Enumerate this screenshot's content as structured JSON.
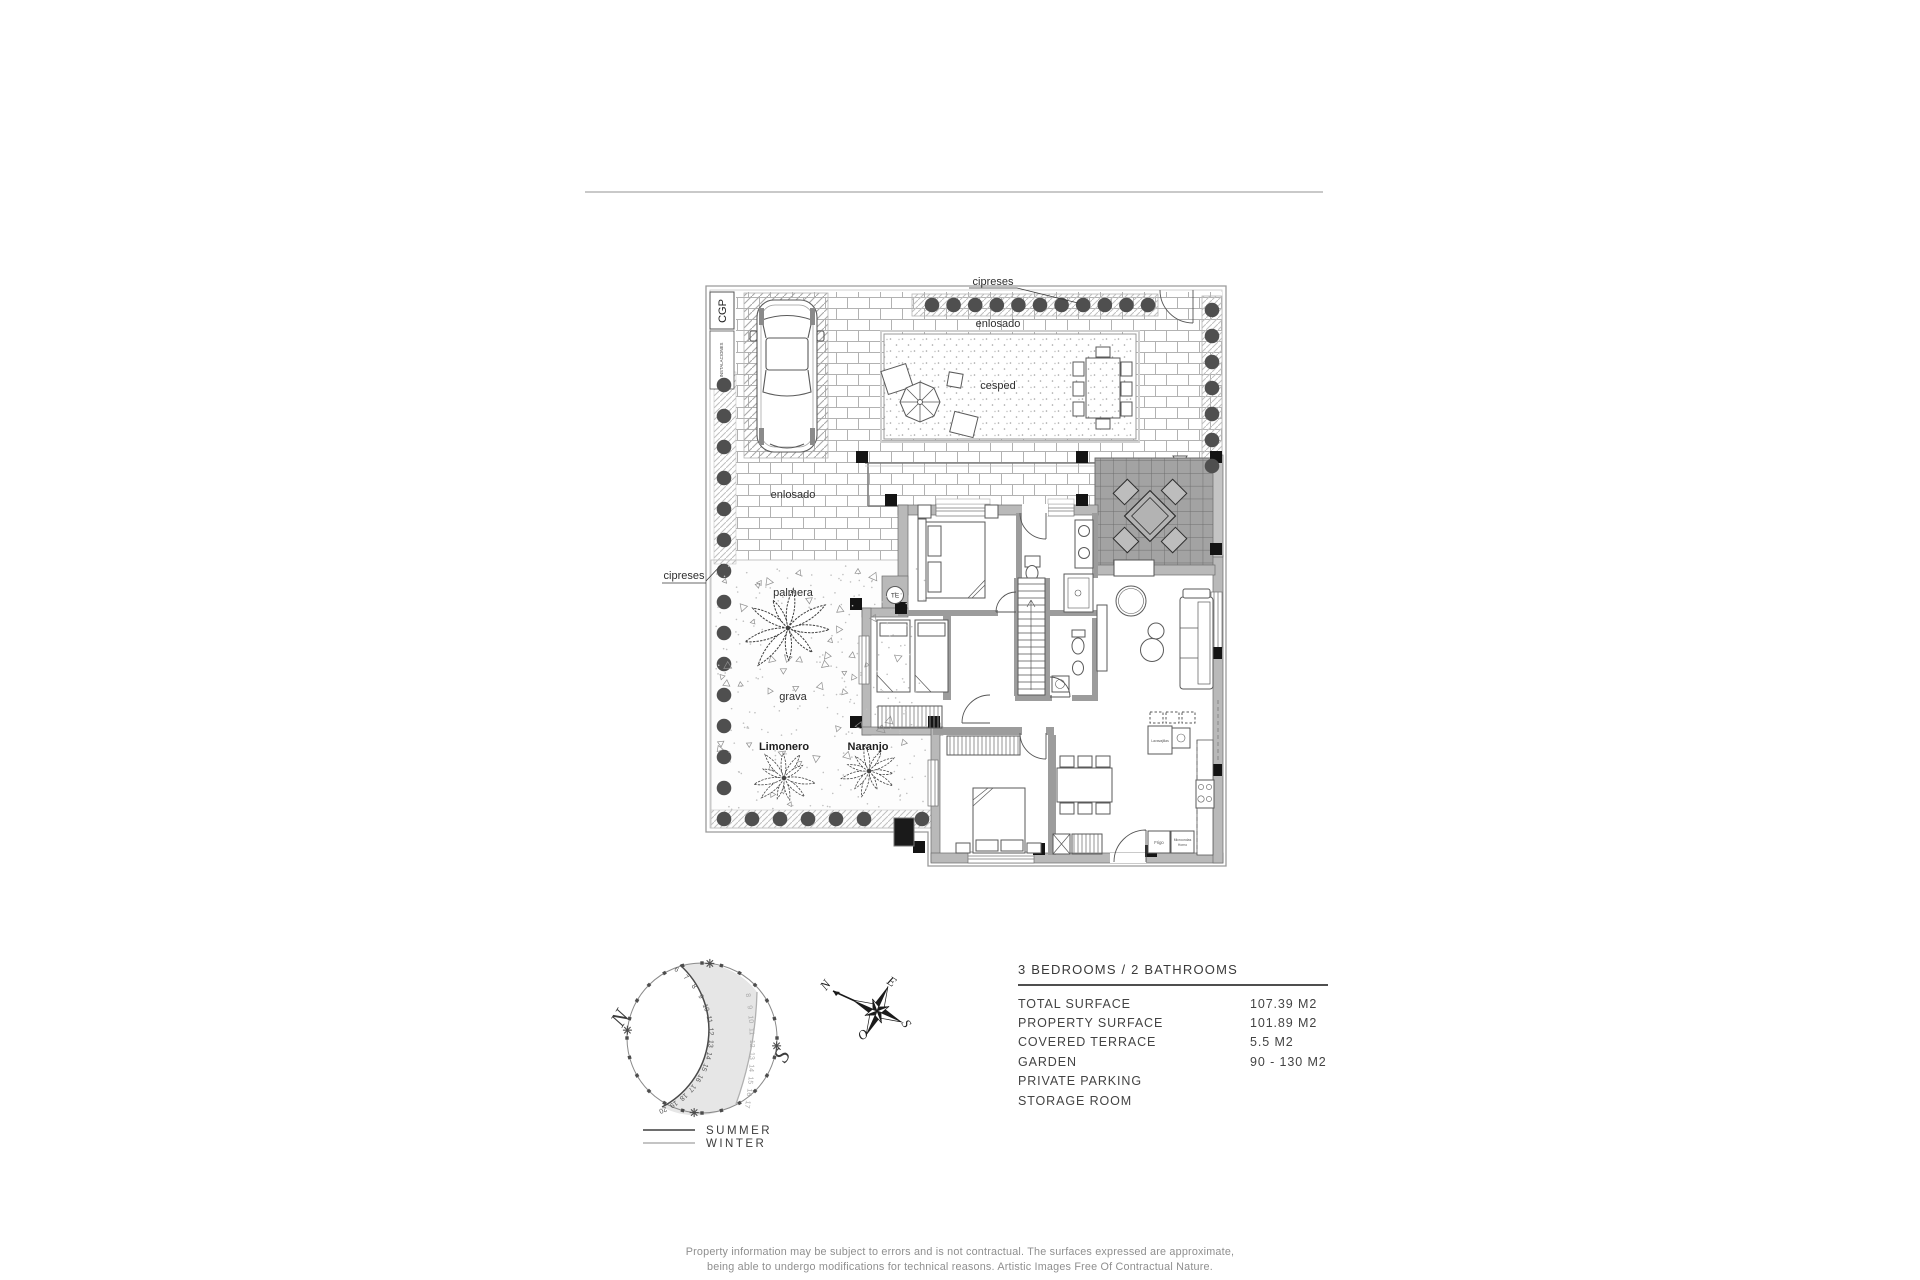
{
  "plan": {
    "garden_labels": {
      "cipreses_top": "cipreses",
      "cipreses_left": "cipreses",
      "enlosado_top": "enlosado",
      "enlosado_mid": "enlosado",
      "cesped": "cesped",
      "palmera": "palmera",
      "grava": "grava",
      "limonero": "Limonero",
      "naranjo": "Naranjo"
    },
    "utility_labels": {
      "cgp": "CGP",
      "instalaciones": "INSTALACIONES",
      "te": "TE"
    },
    "kitchen_labels": {
      "fridge": "Frigo",
      "micro_line1": "Microondas",
      "micro_line2": "Horno",
      "dishwasher": "Lavavajillas"
    }
  },
  "sun_diagram": {
    "north": "N",
    "south": "S",
    "summer_hours": [
      "6",
      "7",
      "8",
      "9",
      "10",
      "11",
      "12",
      "13",
      "14",
      "15",
      "16",
      "17",
      "18",
      "19",
      "20"
    ],
    "winter_hours": [
      "8",
      "9",
      "10",
      "11",
      "12",
      "13",
      "14",
      "15",
      "16",
      "17"
    ],
    "legend_summer": "SUMMER",
    "legend_winter": "WINTER"
  },
  "compass": {
    "north": "N",
    "east": "E",
    "south": "S",
    "west": "O"
  },
  "specs": {
    "title": "3 BEDROOMS / 2 BATHROOMS",
    "rows": [
      {
        "label": "TOTAL SURFACE",
        "value": "107.39 M2"
      },
      {
        "label": "PROPERTY SURFACE",
        "value": "101.89 M2"
      },
      {
        "label": "COVERED TERRACE",
        "value": "5.5 M2"
      },
      {
        "label": "GARDEN",
        "value": "90 - 130 M2"
      },
      {
        "label": "PRIVATE PARKING",
        "value": ""
      },
      {
        "label": "STORAGE ROOM",
        "value": ""
      }
    ]
  },
  "disclaimer": {
    "line1": "Property information may be subject to errors and is not contractual. The surfaces expressed are approximate,",
    "line2": "being able to undergo modifications for technical reasons. Artistic Images Free Of Contractual Nature."
  },
  "colors": {
    "line": "#4a4a4a",
    "wall_fill": "#b9b9b9",
    "terrace_fill": "#a3a3a3",
    "tree": "#4f4f4f",
    "shade": "#e6e6e6",
    "summer_line": "#4a4a4a",
    "winter_line": "#b0b0b0"
  }
}
